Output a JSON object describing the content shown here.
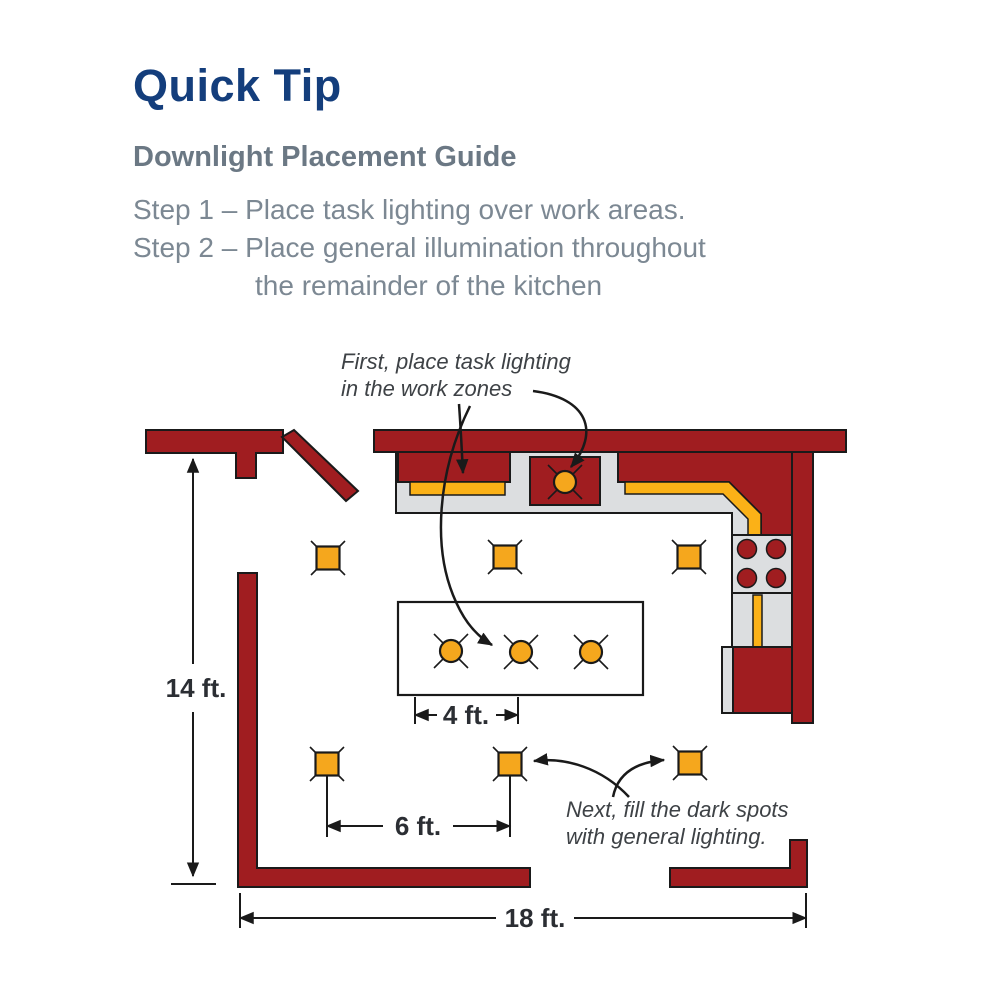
{
  "theme": {
    "title-navy": "#143E7C",
    "subtitle-slate": "#6B7884",
    "step-gray": "#7C8893",
    "annotation-gray": "#3E4246",
    "dimension-dark": "#2B2E33",
    "wall-red": "#A01D20",
    "counter-gray": "#DCDEE0",
    "light-amber": "#F5A71D",
    "strip-yellow": "#FBB117",
    "outline-black": "#1A1A1A"
  },
  "header": {
    "title": "Quick Tip",
    "subtitle": "Downlight Placement Guide",
    "step1": "Step 1 – Place task lighting over work areas.",
    "step2_line1": "Step 2 – Place general illumination throughout",
    "step2_line2": "the remainder of the kitchen"
  },
  "diagram": {
    "annotation_task_line1": "First, place task lighting",
    "annotation_task_line2": "in the work zones",
    "annotation_general_line1": "Next, fill the dark spots",
    "annotation_general_line2": "with general lighting.",
    "dim_room_height": "14 ft.",
    "dim_island_spacing": "4 ft.",
    "dim_general_spacing": "6 ft.",
    "dim_room_width": "18 ft."
  }
}
